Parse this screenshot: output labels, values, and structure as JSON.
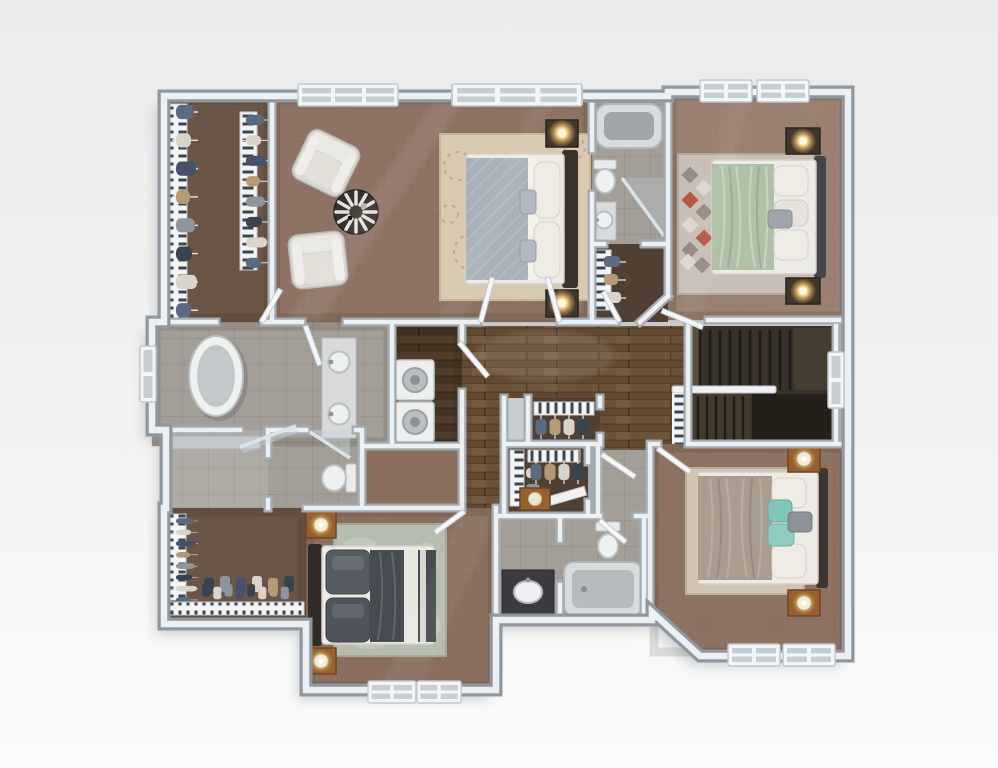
{
  "scene": {
    "type": "3d-floor-plan-rendering",
    "view": "top-down dollhouse view, upper floor of a home",
    "visible_text": "none"
  },
  "palette": {
    "bg_top": "#ebebec",
    "bg_mid": "#f2f2f2",
    "bg_bottom": "#fbfbfb",
    "wall_ext": "#8f98a0",
    "wall_int": "#a4acb3",
    "wall_cap": "#edf0f2",
    "carpet_master": "#8e7365",
    "carpet_bedroom2": "#9a8070",
    "carpet_bedroom3": "#8a6f5f",
    "carpet_bedroom4": "#8d7161",
    "closet_floor": "#6a5546",
    "closet_floor_dark": "#504034",
    "tile": "#a49e98",
    "tile_light": "#aeaaa4",
    "wood_hall": "#6d5339",
    "wood_laundry": "#4f3c29",
    "stair_base": "#38322a",
    "stair_tread": "#1f1c17",
    "rug_cream": "#d7cab0",
    "rug_floral": "#b5a97f",
    "rug_geo": "#c8c0b7",
    "rug_geo_dark": "#968c82",
    "rug_geo_red": "#b25a42",
    "rug_marble": "#b6bcae",
    "rug_beige": "#cfc3b1",
    "mattress": "#edebe5",
    "duvet_gray": "#a9b1ba",
    "duvet_green": "#afc2a8",
    "duvet_charcoal": "#474c52",
    "duvet_taupe": "#a89d8f",
    "pillow_white": "#efece6",
    "pillow_gray": "#9fa5ab",
    "pillow_teal": "#80c5ba",
    "pillow_dark": "#575c62",
    "headboard_dark": "#3a322a",
    "headboard_gray": "#42454a",
    "nightstand_dark": "#3f362c",
    "nightstand_wood": "#96602f",
    "lamp_glow": "#ffedb0",
    "porcelain": "#eff1f1",
    "fixture_rim": "#b8bec1",
    "fixture_inner": "#b6bbbe",
    "glass": "#d8e4e8",
    "appliance": "#eef0f0",
    "counter_dark": "#3c3c40",
    "door": "#f4f6f7",
    "cloth1": "#5b6a80",
    "cloth2": "#d8d4cc",
    "cloth3": "#47526a",
    "cloth4": "#b49b76",
    "cloth5": "#8e959e",
    "cloth6": "#39434f"
  },
  "rooms": [
    {
      "id": "master-closet",
      "name": "Walk-in closet (master, top-left)",
      "floor": "carpet-dark",
      "furniture": [
        "hanging-clothes-rack",
        "hanging-clothes-rack"
      ]
    },
    {
      "id": "master-bedroom",
      "name": "Master bedroom with sitting area",
      "floor": "carpet",
      "furniture": [
        "armchair",
        "armchair",
        "round-accent-table",
        "floral-area-rug",
        "bed",
        "nightstand",
        "nightstand",
        "table-lamp",
        "table-lamp",
        "double-door"
      ]
    },
    {
      "id": "bath-2",
      "name": "Bathroom (top-center strip)",
      "floor": "tile",
      "furniture": [
        "bathtub",
        "toilet",
        "corner-glass-shower",
        "vanity-sink"
      ]
    },
    {
      "id": "bath-2-closet",
      "name": "Closet off bathroom strip",
      "floor": "carpet-dark",
      "furniture": [
        "hanging-clothes-rack",
        "door"
      ]
    },
    {
      "id": "bedroom-2",
      "name": "Bedroom 2 (top-right) with sage green bed",
      "floor": "carpet",
      "furniture": [
        "bed",
        "geometric-area-rug",
        "nightstand",
        "nightstand",
        "table-lamp",
        "table-lamp",
        "door"
      ]
    },
    {
      "id": "master-bathroom",
      "name": "Master bathroom with freestanding tub and double vanity",
      "floor": "tile",
      "furniture": [
        "freestanding-tub",
        "double-vanity",
        "sink",
        "sink",
        "window"
      ]
    },
    {
      "id": "shower-room",
      "name": "Walk-in shower room with bench",
      "floor": "tile",
      "furniture": [
        "bench",
        "glass-door"
      ]
    },
    {
      "id": "water-closet",
      "name": "Water closet",
      "floor": "tile",
      "furniture": [
        "toilet",
        "glass-door"
      ]
    },
    {
      "id": "laundry",
      "name": "Laundry room",
      "floor": "hardwood-dark",
      "furniture": [
        "washer",
        "dryer",
        "door"
      ]
    },
    {
      "id": "hallway",
      "name": "Hallway / landing",
      "floor": "hardwood",
      "furniture": []
    },
    {
      "id": "staircase",
      "name": "Staircase going down",
      "floor": "wood-stairs",
      "furniture": [
        "handrail",
        "balusters",
        "window"
      ]
    },
    {
      "id": "linen-closet",
      "name": "Linen closet (center)",
      "floor": "carpet-dark",
      "furniture": [
        "hanging-clothes-rack",
        "shelf"
      ]
    },
    {
      "id": "closet-bedroom-3",
      "name": "Walk-in closet (center, bedroom 3)",
      "floor": "carpet-dark",
      "furniture": [
        "hanging-clothes-rack",
        "hanging-clothes-rack",
        "dresser",
        "shelf-board"
      ]
    },
    {
      "id": "bedroom-3",
      "name": "Bedroom 3 (bottom-center) with charcoal bed",
      "floor": "carpet",
      "furniture": [
        "bed",
        "area-rug",
        "nightstand",
        "nightstand",
        "table-lamp",
        "table-lamp",
        "windows",
        "door"
      ]
    },
    {
      "id": "bathroom-3",
      "name": "Hall bathroom (bottom-center)",
      "floor": "tile",
      "furniture": [
        "vanity-sink",
        "toilet",
        "bathtub",
        "door"
      ]
    },
    {
      "id": "bedroom-4",
      "name": "Bedroom 4 (bottom-right) with teal accent pillows",
      "floor": "carpet",
      "furniture": [
        "bed",
        "area-rug",
        "nightstand",
        "nightstand",
        "table-lamp",
        "table-lamp",
        "windows",
        "door"
      ]
    },
    {
      "id": "closet-guest",
      "name": "Walk-in closet (bottom-left) with shoe shelf",
      "floor": "carpet-dark",
      "furniture": [
        "hanging-clothes-rack",
        "clothes-row",
        "shoe-row",
        "shelf"
      ]
    }
  ]
}
